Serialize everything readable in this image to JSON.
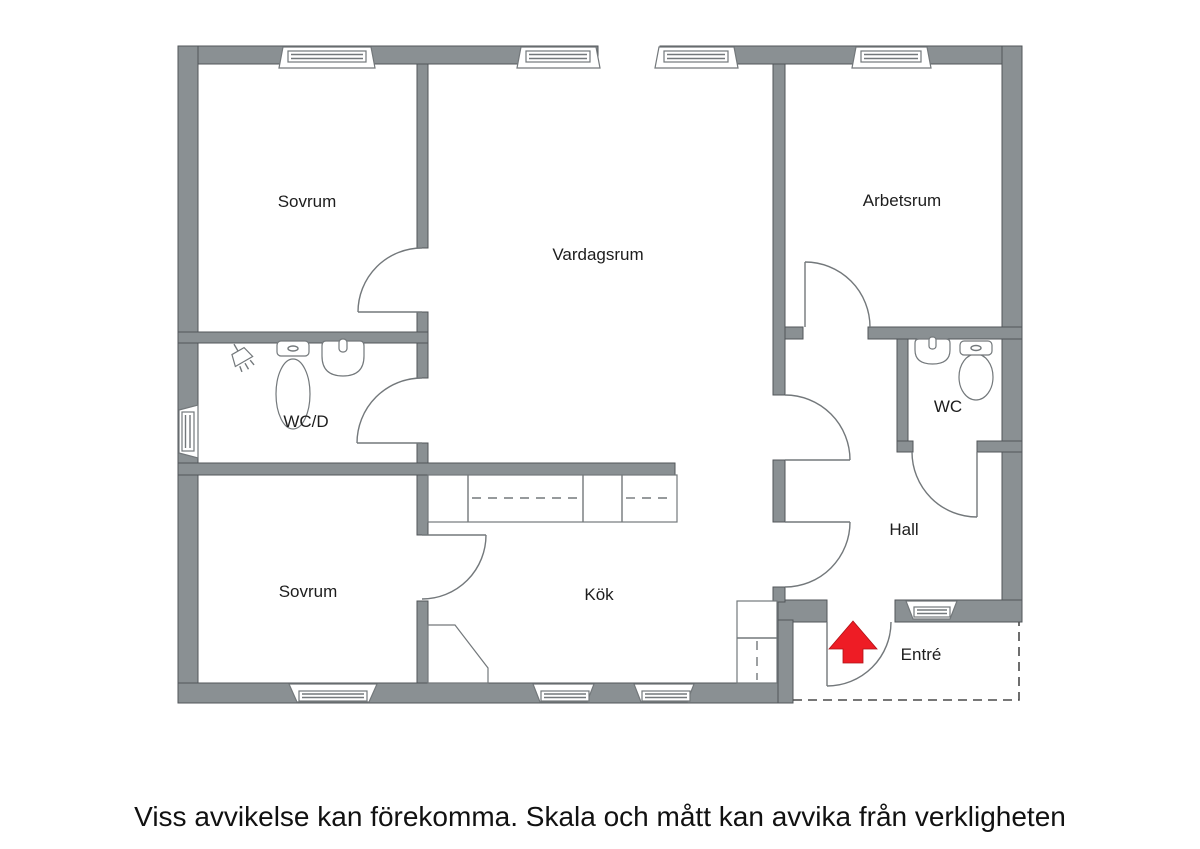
{
  "plan": {
    "rooms": [
      {
        "id": "sovrum-top",
        "label": "Sovrum"
      },
      {
        "id": "vardagsrum",
        "label": "Vardagsrum"
      },
      {
        "id": "arbetsrum",
        "label": "Arbetsrum"
      },
      {
        "id": "wcd",
        "label": "WC/D"
      },
      {
        "id": "sovrum-bottom",
        "label": "Sovrum"
      },
      {
        "id": "kok",
        "label": "Kök"
      },
      {
        "id": "wc",
        "label": "WC"
      },
      {
        "id": "hall",
        "label": "Hall"
      },
      {
        "id": "entre",
        "label": "Entré"
      }
    ],
    "fixtures": [
      {
        "room": "WC/D",
        "items": [
          "shower",
          "toilet",
          "sink"
        ]
      },
      {
        "room": "WC",
        "items": [
          "sink",
          "toilet"
        ]
      },
      {
        "room": "Kök",
        "items": [
          "counter",
          "cabinet"
        ]
      },
      {
        "room": "Sovrum",
        "items": [
          "corner-closet"
        ]
      }
    ],
    "entrance_marker": "red-arrow-up",
    "colors": {
      "wall": "#8a9093",
      "wall_outline": "#51565a",
      "line": "#73787b",
      "arrow_red": "#ee1c25",
      "text": "#1d1d1d",
      "background": "#ffffff"
    }
  },
  "footer": {
    "disclaimer": "Viss avvikelse kan förekomma. Skala och mått kan avvika från verkligheten"
  }
}
